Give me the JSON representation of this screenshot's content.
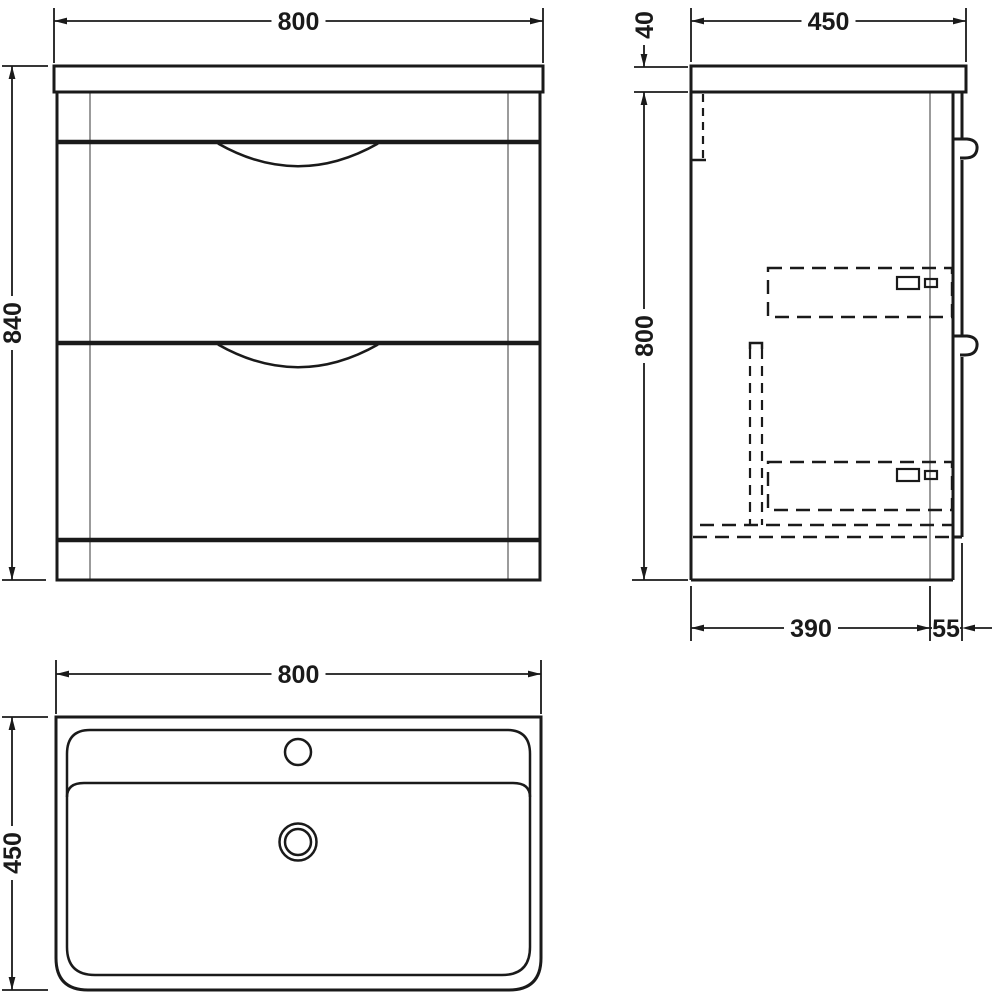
{
  "colors": {
    "line": "#1a1a1a",
    "hidden_gray": "#9b9b9b",
    "background": "#ffffff"
  },
  "front_view": {
    "width_dim": "800",
    "height_dim": "840"
  },
  "side_view": {
    "depth_dim": "450",
    "top_thickness_dim": "40",
    "height_dim": "800",
    "base_depth_dim": "390",
    "front_offset_dim": "55"
  },
  "plan_view": {
    "width_dim": "800",
    "depth_dim": "450"
  }
}
